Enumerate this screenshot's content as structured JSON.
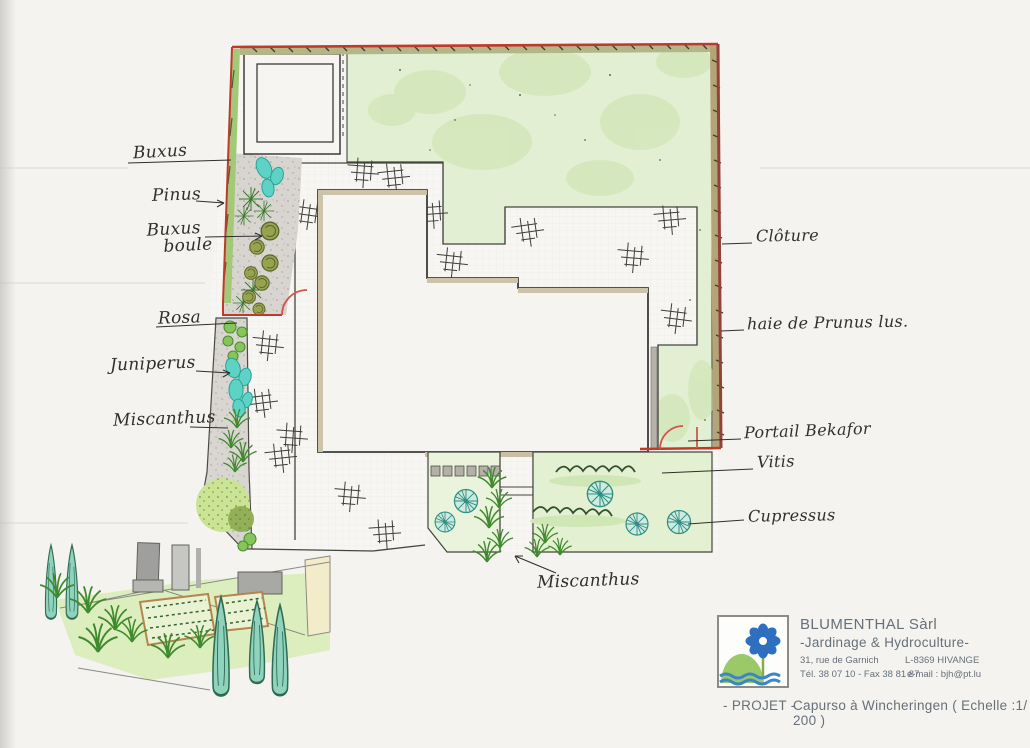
{
  "plan": {
    "labels": {
      "buxus": "Buxus",
      "pinus": "Pinus",
      "buxus_boule_1": "Buxus",
      "buxus_boule_2": "boule",
      "rosa": "Rosa",
      "juniperus": "Juniperus",
      "miscanthus_left": "Miscanthus",
      "cloture": "Clôture",
      "haie": "haie de Prunus lus.",
      "portail": "Portail Bekafor",
      "vitis": "Vitis",
      "cupressus": "Cupressus",
      "miscanthus_bottom": "Miscanthus"
    }
  },
  "title_block": {
    "company": "BLUMENTHAL Sàrl",
    "tagline": "-Jardinage & Hydroculture-",
    "street": "31, rue de Garnich",
    "city": "L-8369 HIVANGE",
    "phone": "Tél. 38 07 10 - Fax 38 81 87",
    "email": "e-mail : bjh@pt.lu",
    "project_prefix": "- PROJET -",
    "project_title": "Capurso à Wincheringen ( Echelle :1/ 200 )"
  },
  "colors": {
    "boundary_red": "#c0392b",
    "hedge_tan": "#b5a478",
    "lawn_green": "#e3efd3",
    "teal_plant": "#5fd2c6",
    "logo_blue": "#2e6fc0",
    "logo_green": "#9cc968",
    "water_blue": "#3a86c8",
    "handwriting": "#2f2f2b",
    "print_gray": "#66707a"
  }
}
